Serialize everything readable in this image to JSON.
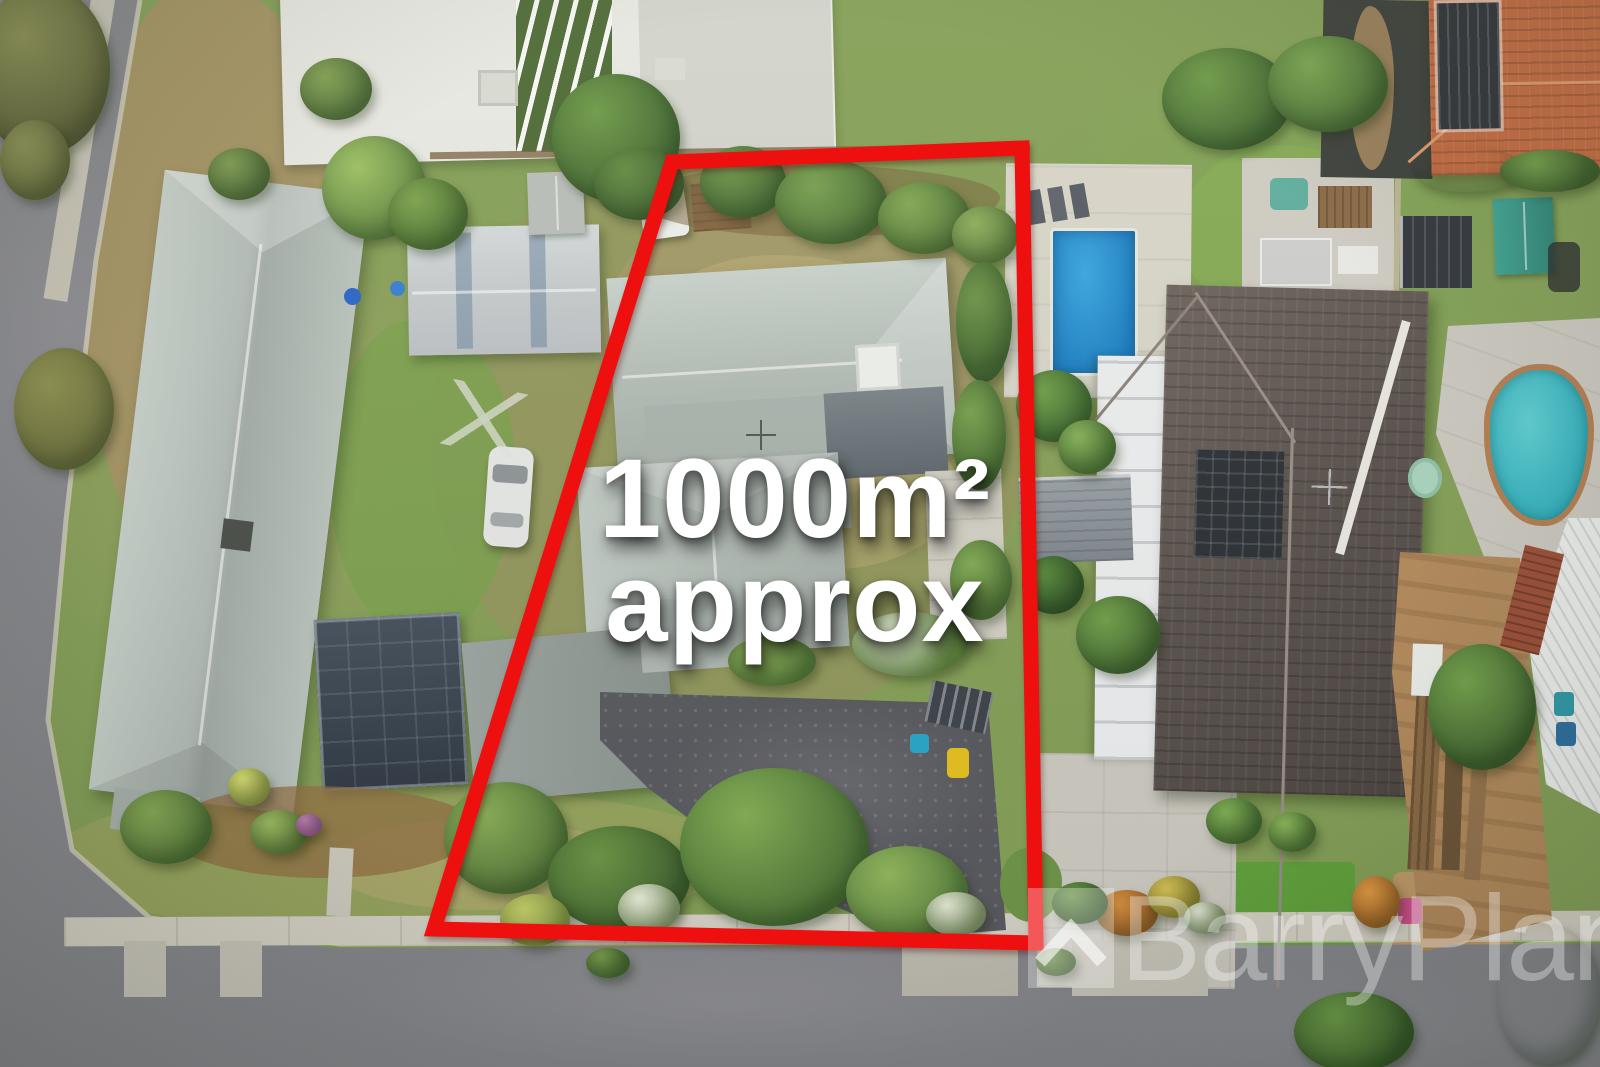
{
  "overlay": {
    "area_text_line1": "1000m²",
    "area_text_line2": "approx",
    "boundary_color": "#ee0f0f",
    "text_color": "#ffffff"
  },
  "watermark": {
    "brand_text": "BarryPlant",
    "logo_icon": "barry-plant-house-logo",
    "color": "#ffffff"
  },
  "scene": {
    "type": "aerial-drone-photograph",
    "subject": "residential block outlined in red, approx 1000 square metres",
    "palette": {
      "asphalt_road": "#86878c",
      "concrete_path": "#d5d1c5",
      "subject_metal_roof": "#b7c0bb",
      "dark_tile_roof": "#5e5652",
      "terracotta_roof": "#c26a40",
      "pool_blue": "#2391cf",
      "pool_turquoise": "#49c3cb",
      "grass_green": "#85a058",
      "tree_green": "#5e8a40",
      "dirt_tan": "#b38a5c",
      "gravel_driveway": "#595a5f"
    }
  }
}
